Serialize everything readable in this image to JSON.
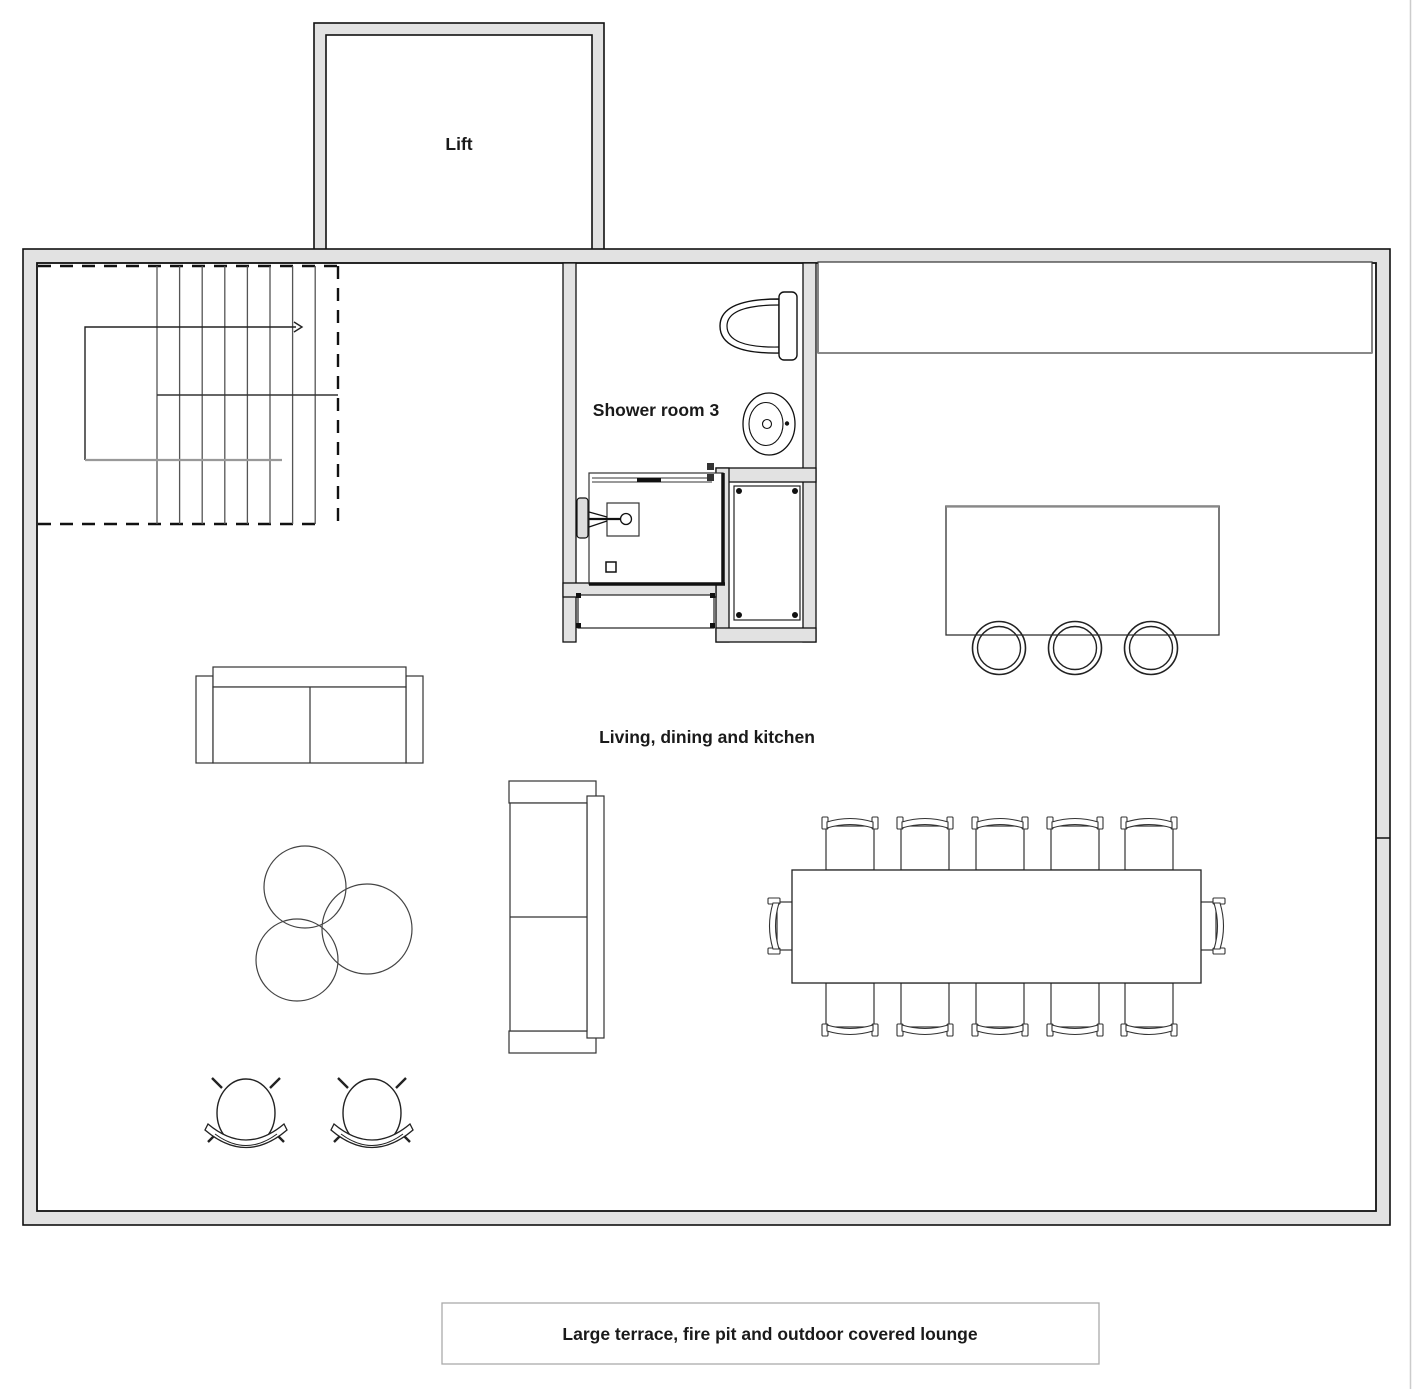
{
  "labels": {
    "lift": "Lift",
    "shower_room": "Shower room 3",
    "living_area": "Living, dining and kitchen",
    "caption": "Large terrace, fire pit and outdoor covered lounge"
  },
  "colors": {
    "wall_fill": "#e2e2e2",
    "wall_line": "#111111",
    "furniture_line": "#333333",
    "background": "#ffffff"
  }
}
